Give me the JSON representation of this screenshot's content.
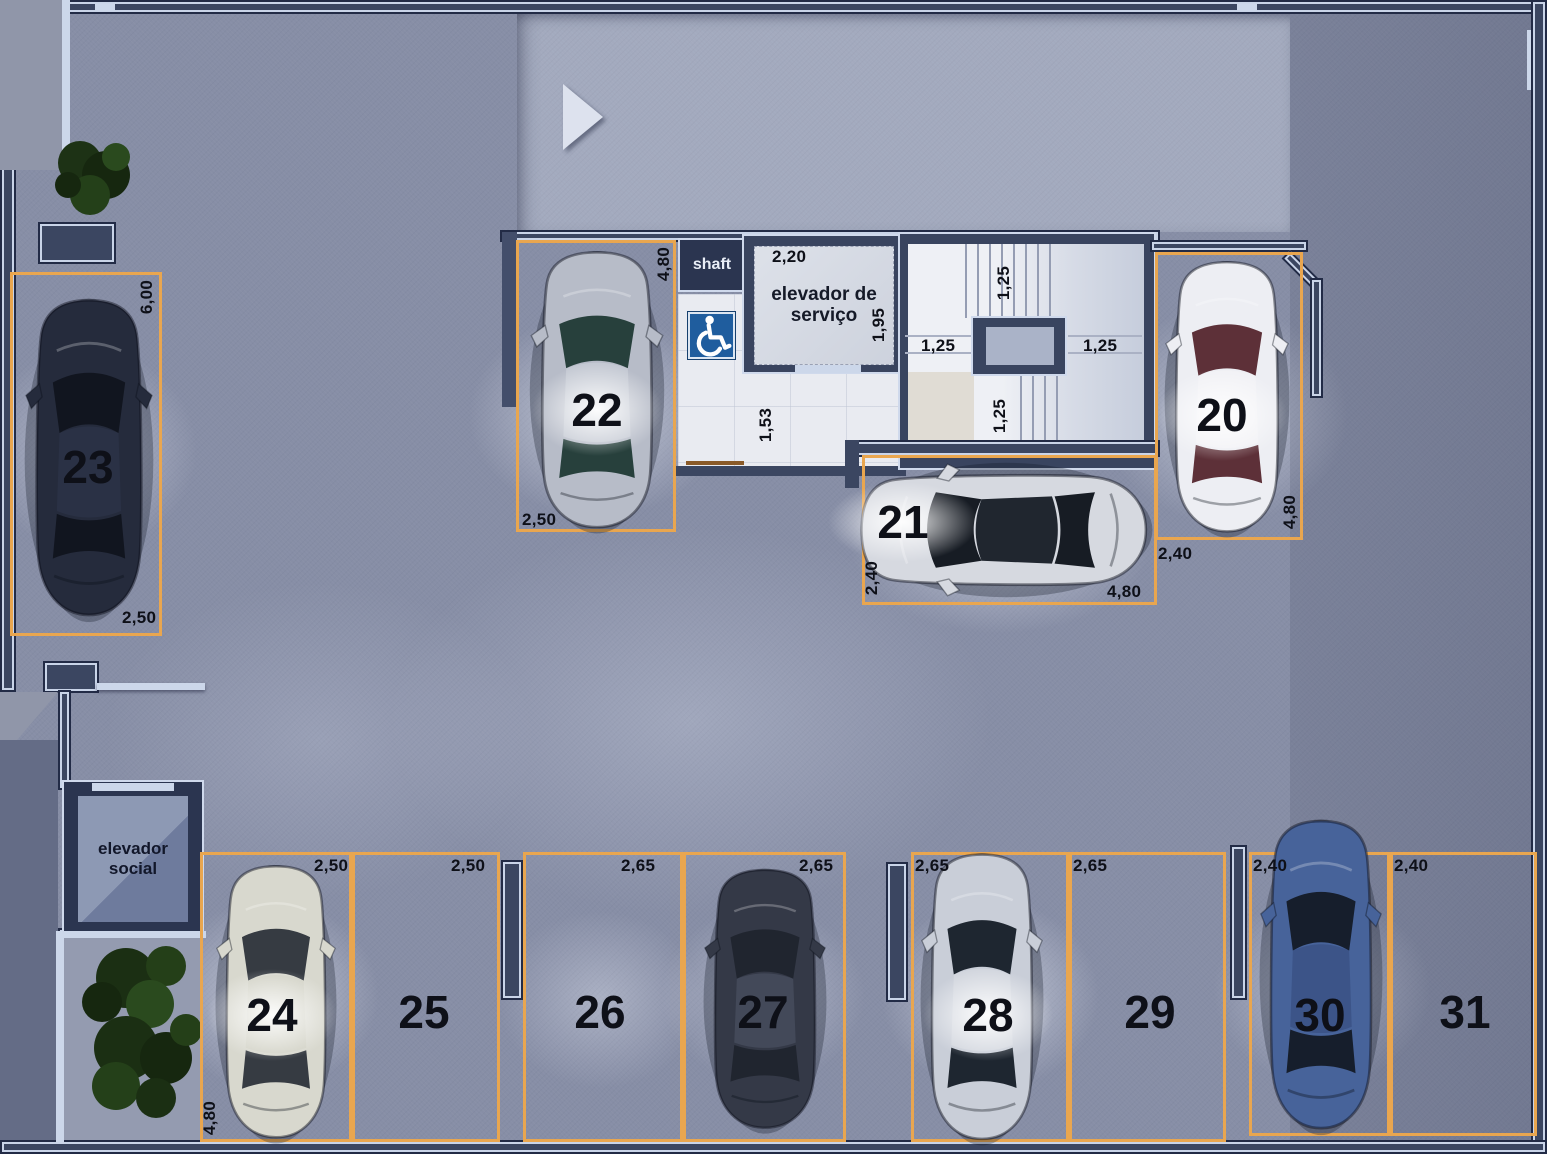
{
  "core": {
    "shaft_label": "shaft",
    "service_elevator_label": "elevador de serviço",
    "service_elevator_width": "2,20",
    "service_elevator_depth": "1,95",
    "lobby_dim": "1,53",
    "stair_dims": [
      "1,25",
      "1,25",
      "1,25",
      "1,25"
    ],
    "social_elevator_label": "elevador social"
  },
  "stalls": [
    {
      "number": "20",
      "width": "2,40",
      "depth": "4,80",
      "occupied": true,
      "car": {
        "body": "#edeef3",
        "glass": "#5d3038",
        "roof": "#f1f1f5"
      }
    },
    {
      "number": "21",
      "width": "2,40",
      "depth": "4,80",
      "occupied": true,
      "car": {
        "body": "#d6d9e0",
        "glass": "#171c24",
        "roof": "#20262f"
      }
    },
    {
      "number": "22",
      "width": "2,50",
      "depth": "4,80",
      "occupied": true,
      "car": {
        "body": "#b7bcc8",
        "glass": "#27403c",
        "roof": "#c4c9d3"
      }
    },
    {
      "number": "23",
      "width": "2,50",
      "depth": "6,00",
      "occupied": true,
      "car": {
        "body": "#252b3c",
        "glass": "#11151f",
        "roof": "#2a3145"
      }
    },
    {
      "number": "24",
      "width": "2,50",
      "depth": "4,80",
      "occupied": true,
      "car": {
        "body": "#d8d8ce",
        "glass": "#363b42",
        "roof": "#d2d2c6"
      }
    },
    {
      "number": "25",
      "width": "2,50",
      "occupied": false
    },
    {
      "number": "26",
      "width": "2,65",
      "occupied": false
    },
    {
      "number": "27",
      "width": "2,65",
      "occupied": true,
      "car": {
        "body": "#343947",
        "glass": "#20252f",
        "roof": "#434959"
      }
    },
    {
      "number": "28",
      "width": "2,65",
      "occupied": true,
      "car": {
        "body": "#c9ced8",
        "glass": "#1e2630",
        "roof": "#d2d6de"
      }
    },
    {
      "number": "29",
      "width": "2,65",
      "occupied": false
    },
    {
      "number": "30",
      "width": "2,40",
      "occupied": true,
      "car": {
        "body": "#47639a",
        "glass": "#161e2c",
        "roof": "#3c5488"
      }
    },
    {
      "number": "31",
      "width": "2,40",
      "occupied": false
    }
  ],
  "icons": {
    "entrance_arrow": "right-arrow",
    "accessible_parking": "wheelchair"
  },
  "colors": {
    "stall_border": "#e9a64f",
    "accessible_sign_blue": "#1f5d9e",
    "wall": "#3b4661",
    "wall_highlight": "#ccd7ea",
    "floor": "#878ea6",
    "ramp": "#a3aabe"
  }
}
